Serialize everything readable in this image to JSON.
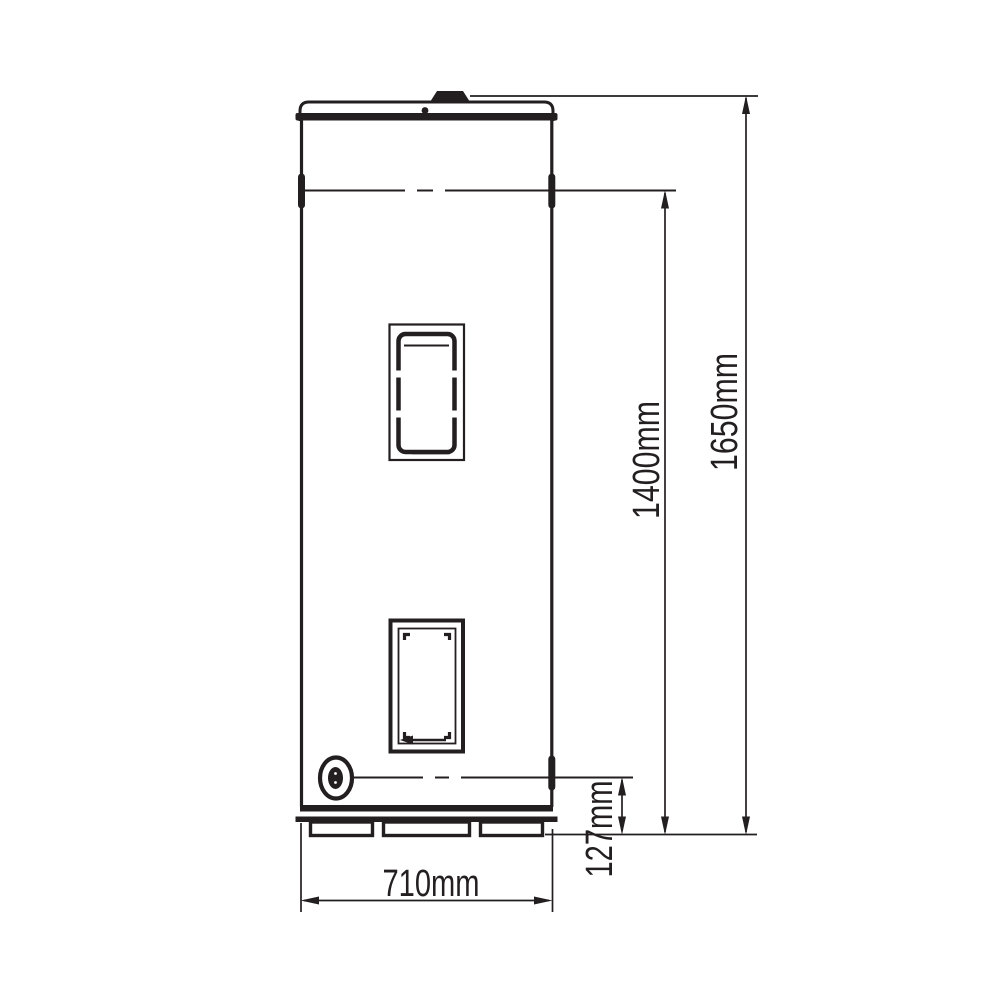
{
  "colors": {
    "line": "#231f20",
    "background": "#ffffff"
  },
  "drawing": {
    "type": "technical-dimension-drawing",
    "subject": "hot-water-cylinder-front-elevation",
    "labels": {
      "overall_height": "1650mm",
      "upper_connection_height": "1400mm",
      "drain_height": "127mm",
      "base_width": "710mm"
    }
  }
}
